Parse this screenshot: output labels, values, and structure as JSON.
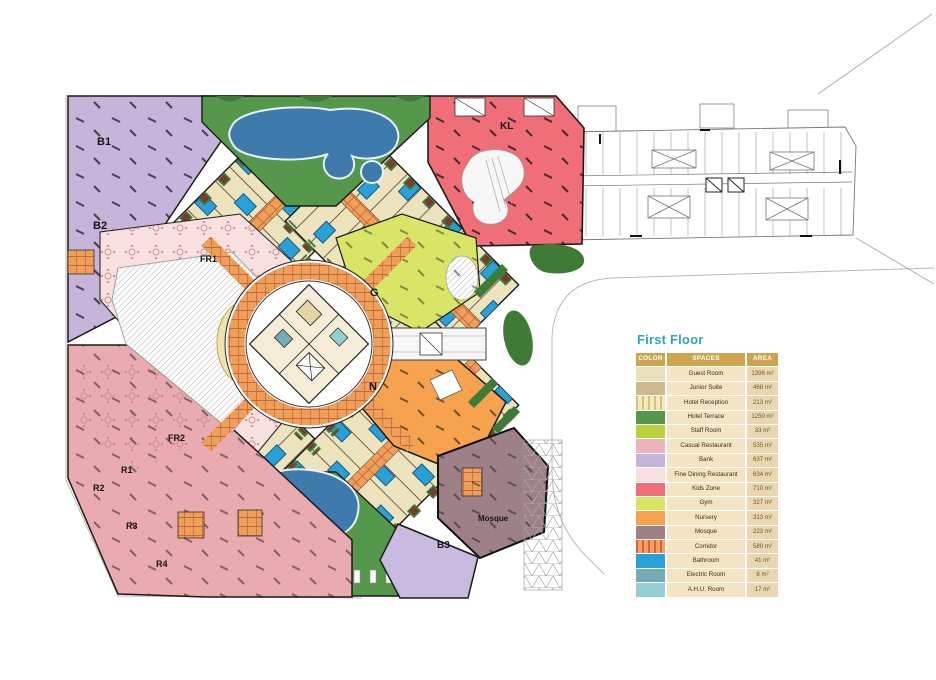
{
  "legend": {
    "title": "First Floor",
    "title_color": "#2BA6BD",
    "header": {
      "color": "COLOR",
      "spaces": "SPACES",
      "area": "AREA"
    },
    "header_bg": "#CFA44E",
    "rows": [
      {
        "space": "Guest Room",
        "area": "1396 m²",
        "swatch": "#E9E0BC"
      },
      {
        "space": "Junior Suite",
        "area": "468 m²",
        "swatch": "#CCBA8E"
      },
      {
        "space": "Hotel Reception",
        "area": "213 m²",
        "swatch": "#F2E9C5",
        "stripes": "#D8C276"
      },
      {
        "space": "Hotel Terrace",
        "area": "1250 m²",
        "swatch": "#55984B"
      },
      {
        "space": "Staff Room",
        "area": "33 m²",
        "swatch": "#B8D23B"
      },
      {
        "space": "Casual Restaurant",
        "area": "535 m²",
        "swatch": "#ECB3BC"
      },
      {
        "space": "Bank",
        "area": "637 m²",
        "swatch": "#C6B4DB"
      },
      {
        "space": "Fine Dining Restaurant",
        "area": "634 m²",
        "swatch": "#F8E0E1"
      },
      {
        "space": "Kids Zone",
        "area": "710 m²",
        "swatch": "#EF6E77"
      },
      {
        "space": "Gym",
        "area": "327 m²",
        "swatch": "#D9E567"
      },
      {
        "space": "Nursery",
        "area": "313 m²",
        "swatch": "#F6A24F"
      },
      {
        "space": "Mosque",
        "area": "223 m²",
        "swatch": "#9D8186"
      },
      {
        "space": "Corridor",
        "area": "580 m²",
        "swatch": "#F0A459",
        "stripes": "#E05A50"
      },
      {
        "space": "Bathroom",
        "area": "41 m²",
        "swatch": "#2B9FD8"
      },
      {
        "space": "Electric Room",
        "area": "8 m²",
        "swatch": "#74ABB7"
      },
      {
        "space": "A.H.U. Room",
        "area": "17 m²",
        "swatch": "#93D0D1"
      }
    ]
  },
  "plan": {
    "colors": {
      "guest_room": "#EDE4BE",
      "junior_suite": "#CCBA8E",
      "terrace": "#55984B",
      "staff": "#B8D23B",
      "casual": "#E9ABB0",
      "bank": "#C6B4DB",
      "fine_dining": "#F8E0E1",
      "kids": "#EF6E77",
      "gym": "#D9E567",
      "nursery": "#F6A24F",
      "mosque": "#9D8186",
      "b3_bank": "#C9BADF",
      "bathroom": "#2B9FD8",
      "electric": "#74ABB7",
      "ahu": "#93D0D1",
      "pool": "#3E7BAC",
      "landscape": "#3F7A37",
      "desk_gold": "#D9B84C",
      "desk_gold_light": "#F0E3B0"
    },
    "labels": [
      {
        "text": "B1",
        "x": 97,
        "y": 145,
        "size": 11
      },
      {
        "text": "B2",
        "x": 93,
        "y": 229,
        "size": 11
      },
      {
        "text": "FR1",
        "x": 200,
        "y": 262,
        "size": 9
      },
      {
        "text": "FR2",
        "x": 168,
        "y": 441,
        "size": 9
      },
      {
        "text": "R1",
        "x": 121,
        "y": 473,
        "size": 9
      },
      {
        "text": "R2",
        "x": 93,
        "y": 491,
        "size": 9
      },
      {
        "text": "R3",
        "x": 126,
        "y": 529,
        "size": 9
      },
      {
        "text": "R4",
        "x": 156,
        "y": 567,
        "size": 9
      },
      {
        "text": "KL",
        "x": 500,
        "y": 129,
        "size": 10
      },
      {
        "text": "G",
        "x": 370,
        "y": 296,
        "size": 11
      },
      {
        "text": "N",
        "x": 369,
        "y": 390,
        "size": 11
      },
      {
        "text": "Mosque",
        "x": 478,
        "y": 521,
        "size": 8
      },
      {
        "text": "B3",
        "x": 437,
        "y": 548,
        "size": 10
      }
    ]
  }
}
